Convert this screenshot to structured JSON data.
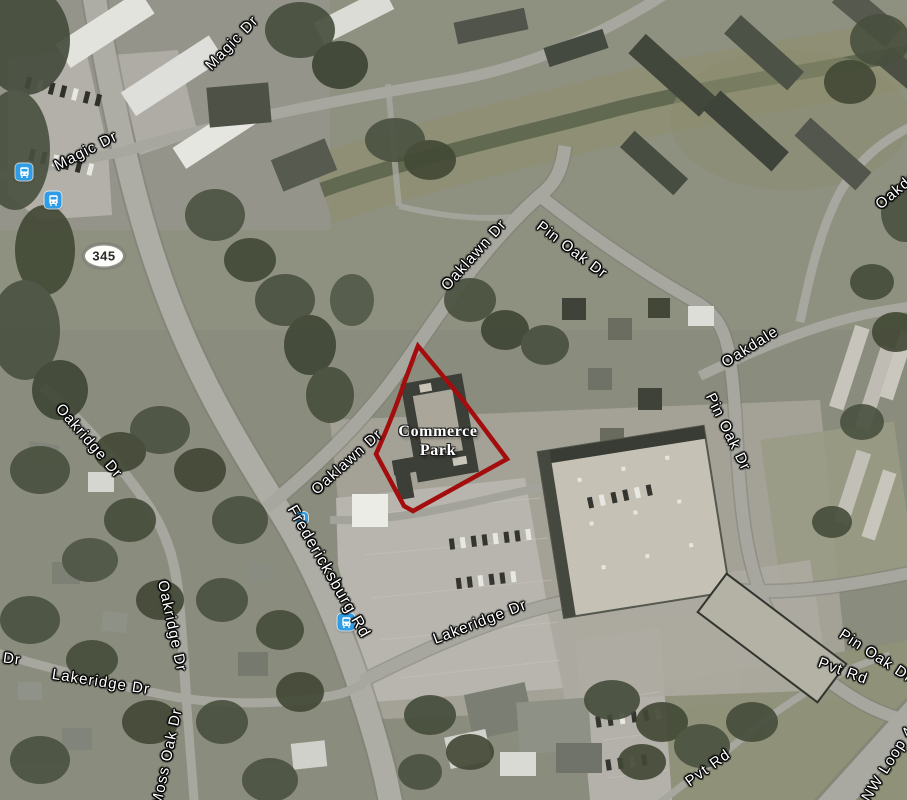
{
  "map": {
    "view_type": "satellite",
    "route_badge": {
      "label": "345",
      "x": 104,
      "y": 256
    },
    "parcel_overlay": {
      "name": "Commerce Park",
      "label_lines": [
        "Commerce",
        "Park"
      ],
      "outline_color": "#a30d0d",
      "label_x": 438,
      "label_y": 441
    },
    "street_labels": [
      {
        "name": "magic-dr-upper",
        "text": "Magic Dr",
        "x": 232,
        "y": 43,
        "rot": -46
      },
      {
        "name": "magic-dr-left",
        "text": "Magic Dr",
        "x": 86,
        "y": 151,
        "rot": -27
      },
      {
        "name": "oaklawn-dr-upper",
        "text": "Oaklawn Dr",
        "x": 474,
        "y": 255,
        "rot": -48
      },
      {
        "name": "pin-oak-dr-upper",
        "text": "Pin Oak Dr",
        "x": 572,
        "y": 250,
        "rot": 37
      },
      {
        "name": "oakdale-right-cut",
        "text": "Oakdale",
        "x": 902,
        "y": 186,
        "rot": -40
      },
      {
        "name": "oakdale",
        "text": "Oakdale",
        "x": 750,
        "y": 347,
        "rot": -32
      },
      {
        "name": "pin-oak-dr-right",
        "text": "Pin Oak Dr",
        "x": 728,
        "y": 432,
        "rot": 64
      },
      {
        "name": "oakridge-dr-upper",
        "text": "Oakridge Dr",
        "x": 89,
        "y": 441,
        "rot": 49
      },
      {
        "name": "oaklawn-dr-mid",
        "text": "Oaklawn Dr",
        "x": 347,
        "y": 462,
        "rot": -42
      },
      {
        "name": "fredericksburg-rd",
        "text": "Fredericksburg Rd",
        "x": 328,
        "y": 572,
        "rot": 60,
        "size": 16
      },
      {
        "name": "oakridge-dr-lower",
        "text": "Oakridge Dr",
        "x": 172,
        "y": 626,
        "rot": 78
      },
      {
        "name": "lakeridge-dr-left",
        "text": "Lakeridge Dr",
        "x": 101,
        "y": 682,
        "rot": 9
      },
      {
        "name": "dr-partial-left-edge",
        "text": "Dr",
        "x": 12,
        "y": 659,
        "rot": 8
      },
      {
        "name": "moss-oak-dr",
        "text": "Moss Oak Dr",
        "x": 167,
        "y": 757,
        "rot": -78
      },
      {
        "name": "lakeridge-dr-center",
        "text": "Lakeridge Dr",
        "x": 480,
        "y": 622,
        "rot": -21
      },
      {
        "name": "pvt-rd-upper",
        "text": "Pvt Rd",
        "x": 843,
        "y": 671,
        "rot": 20
      },
      {
        "name": "pin-oak-dr-bottom-cut",
        "text": "Pin Oak Dr",
        "x": 876,
        "y": 656,
        "rot": 33
      },
      {
        "name": "nw-loop-cut",
        "text": "NW Loop 4",
        "x": 888,
        "y": 764,
        "rot": -58
      },
      {
        "name": "pvt-rd-lower",
        "text": "Pvt Rd",
        "x": 708,
        "y": 768,
        "rot": -36
      }
    ],
    "transit_stops": [
      {
        "x": 24,
        "y": 172,
        "size": 17
      },
      {
        "x": 53,
        "y": 200,
        "size": 17
      },
      {
        "x": 302,
        "y": 518,
        "size": 12
      },
      {
        "x": 346,
        "y": 622,
        "size": 17
      }
    ],
    "transit_icon_color": "#2e9ce6"
  }
}
